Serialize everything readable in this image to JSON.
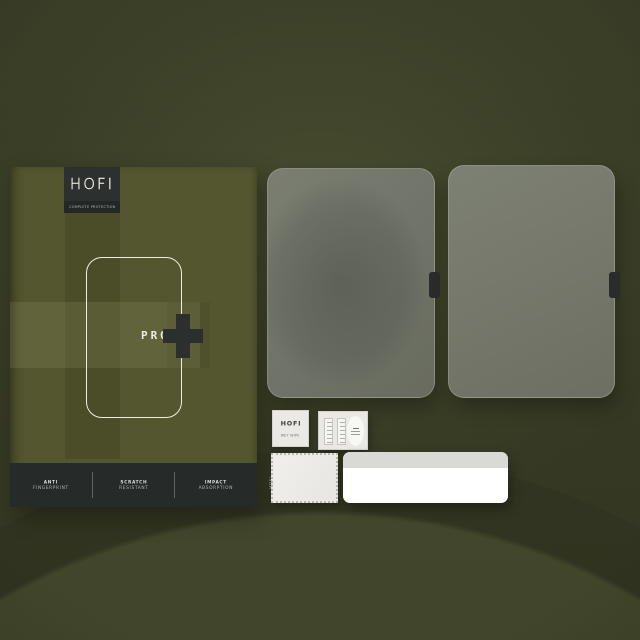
{
  "scene": {
    "background_color": "#3e422a",
    "box_color": "#53562f",
    "panel_color": "#262a29",
    "glass_color": "#72756a",
    "accent_outline_color": "#f0eee0"
  },
  "box": {
    "brand": "HOFI",
    "tagline": "COMPLETE PROTECTION",
    "product_line": "PRO",
    "plus_symbol": "+",
    "features": [
      {
        "line1": "ANTI",
        "line2": "FINGERPRINT"
      },
      {
        "line1": "SCRATCH",
        "line2": "RESISTANT"
      },
      {
        "line1": "IMPACT",
        "line2": "ABSORPTION"
      }
    ]
  },
  "accessories": {
    "wet_wipe": {
      "brand": "HOFI",
      "label": "WET WIPE"
    },
    "cloth": {
      "brand": "HOFI"
    }
  }
}
